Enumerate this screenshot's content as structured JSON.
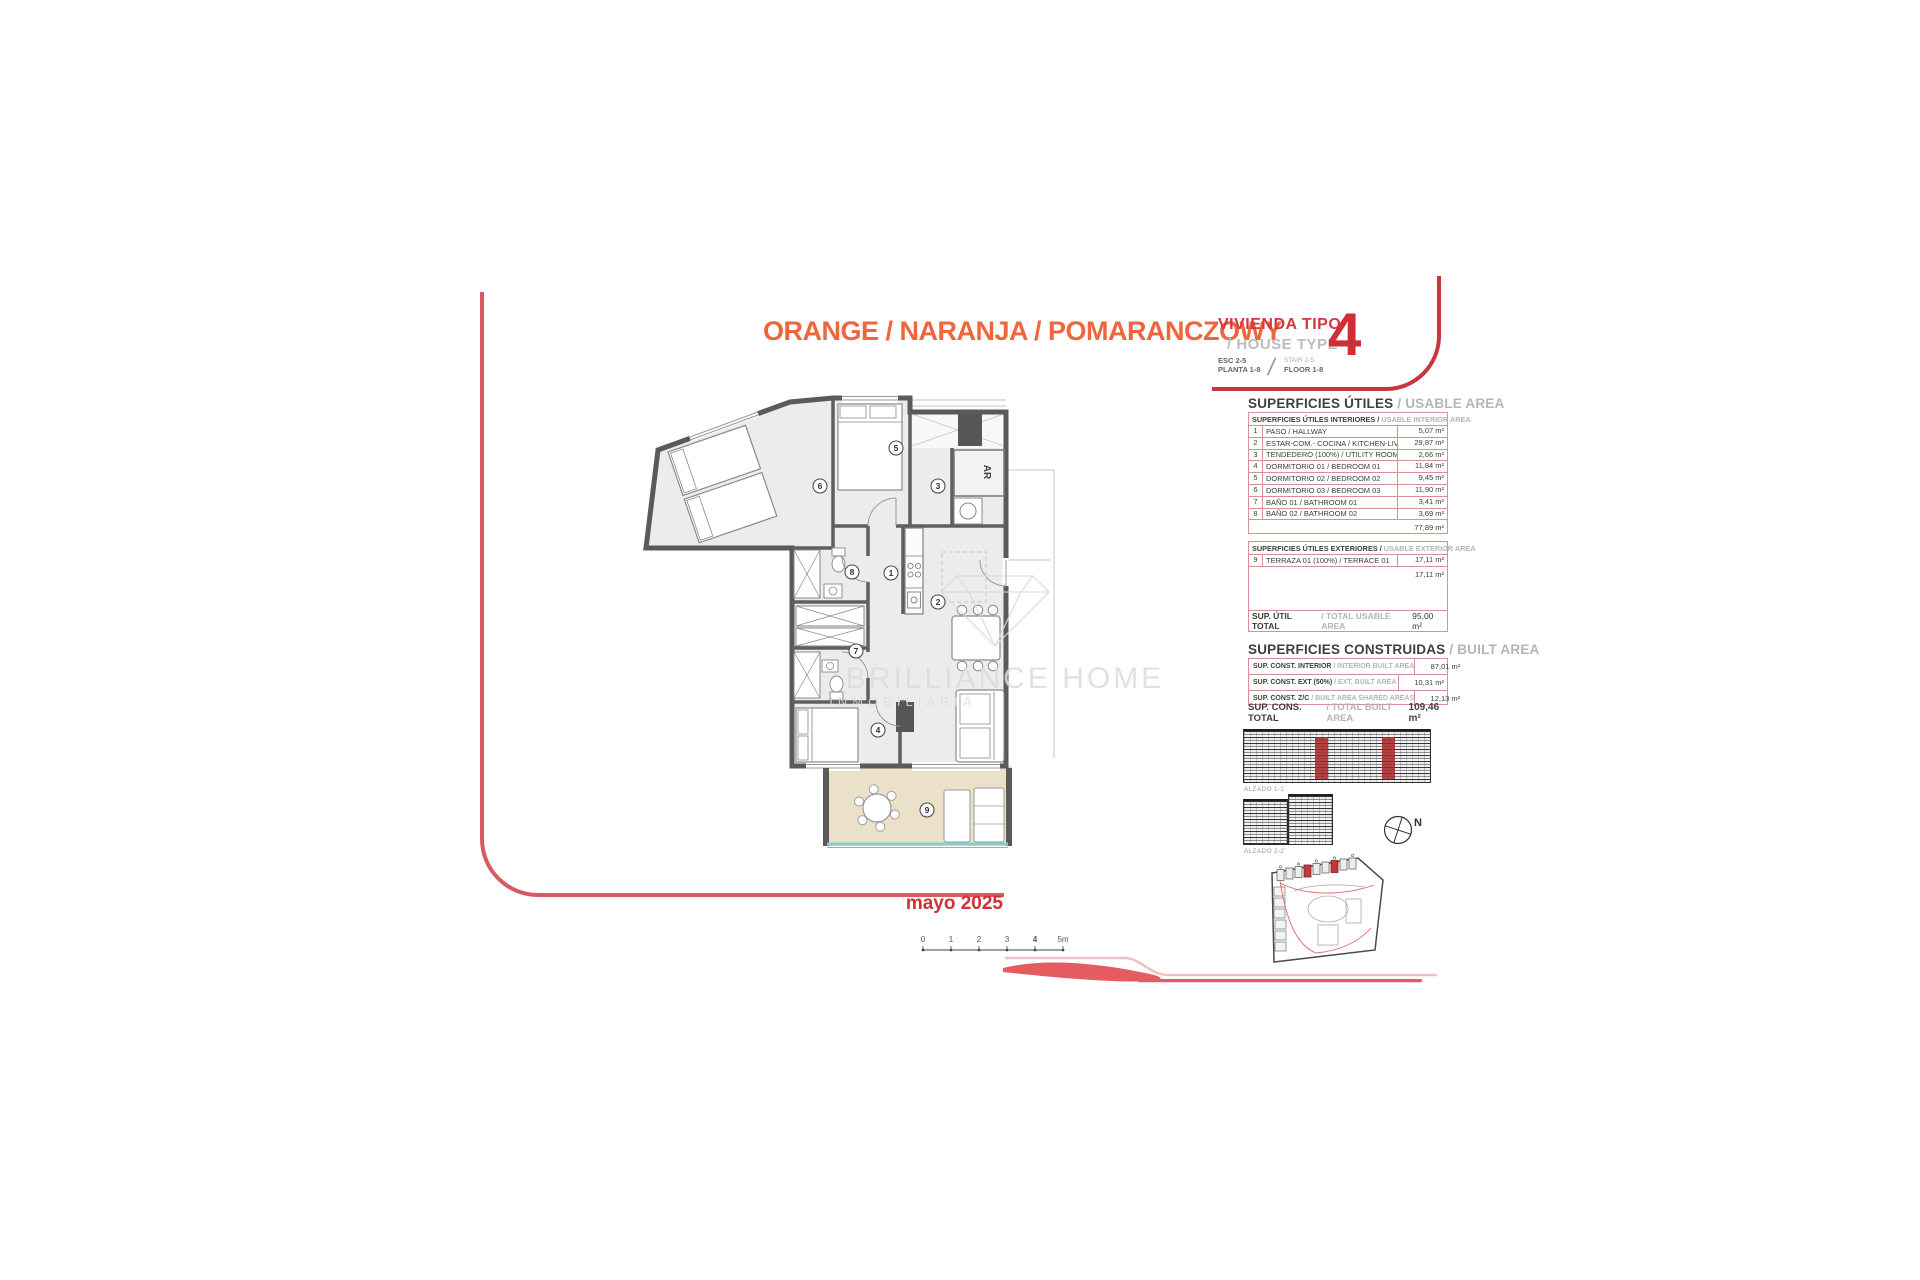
{
  "header": {
    "project_colors": "ORANGE / NARANJA / POMARANCZOWY",
    "vivienda_tipo": "VIVIENDA TIPO",
    "house_type": "/ HOUSE TYPE",
    "esc": "ESC 2-5",
    "planta": "PLANTA 1-8",
    "stair": "STAIR 2-5",
    "floor": "FLOOR 1-8",
    "type_number": "4"
  },
  "usable_area": {
    "title": "SUPERFICIES ÚTILES",
    "title_en": "/ USABLE AREA",
    "interior": {
      "header": "SUPERFICIES ÚTILES INTERIORES /",
      "header_en": "USABLE INTERIOR AREA",
      "rows": [
        {
          "num": "1",
          "label": "PASO / HALLWAY",
          "value": "5,07 m²"
        },
        {
          "num": "2",
          "label": "ESTAR-COM.- COCINA / KITCHEN-LIVING",
          "value": "29,87 m²"
        },
        {
          "num": "3",
          "label": "TENDEDERO (100%) / UTILITY ROOM",
          "value": "2,66 m²"
        },
        {
          "num": "4",
          "label": "DORMITORIO 01 / BEDROOM 01",
          "value": "11,84 m²"
        },
        {
          "num": "5",
          "label": "DORMITORIO 02 / BEDROOM 02",
          "value": "9,45 m²"
        },
        {
          "num": "6",
          "label": "DORMITORIO 03 / BEDROOM 03",
          "value": "11,90 m²"
        },
        {
          "num": "7",
          "label": "BAÑO 01 / BATHROOM 01",
          "value": "3,41 m²"
        },
        {
          "num": "8",
          "label": "BAÑO 02 / BATHROOM 02",
          "value": "3,69 m²"
        }
      ],
      "subtotal": "77,89 m²"
    },
    "exterior": {
      "header": "SUPERFICIES ÚTILES EXTERIORES /",
      "header_en": "USABLE EXTERIOR AREA",
      "rows": [
        {
          "num": "9",
          "label": "TERRAZA 01 (100%) / TERRACE 01",
          "value": "17,11 m²"
        }
      ],
      "subtotal": "17,11 m²"
    },
    "total": {
      "label": "SUP. ÚTIL TOTAL",
      "label_en": "/ TOTAL USABLE AREA",
      "value": "95,00 m²"
    }
  },
  "built_area": {
    "title": "SUPERFICIES CONSTRUIDAS",
    "title_en": "/ BUILT AREA",
    "rows": [
      {
        "label": "SUP. CONST. INTERIOR ",
        "label_en": "/ INTERIOR BUILT AREA",
        "value": "87,01 m²"
      },
      {
        "label": "SUP. CONST. EXT (50%) ",
        "label_en": "/ EXT. BUILT AREA",
        "value": "10,31 m²"
      },
      {
        "label": "SUP. CONST. Z/C ",
        "label_en": "/ BUILT AREA SHARED AREAS",
        "value": "12,13 m²"
      }
    ],
    "total": {
      "label": "SUP. CONS. TOTAL",
      "label_en": "/ TOTAL BUILT AREA",
      "value": "109,46 m²"
    }
  },
  "elevations": {
    "alzado_1": "ALZADO 1-1'",
    "alzado_2": "ALZADO 2-2'",
    "north_label": "N"
  },
  "floorplan": {
    "rooms": [
      "1",
      "2",
      "3",
      "4",
      "5",
      "6",
      "7",
      "8",
      "9"
    ],
    "ar_label": "AR",
    "watermark_line1": "BRILLIANCE HOME",
    "watermark_line2": "INMOBILIARIA"
  },
  "scalebar": {
    "ticks": [
      "0",
      "1",
      "2",
      "3",
      "4",
      "5m"
    ]
  },
  "footer": {
    "date": "mayo 2025"
  }
}
